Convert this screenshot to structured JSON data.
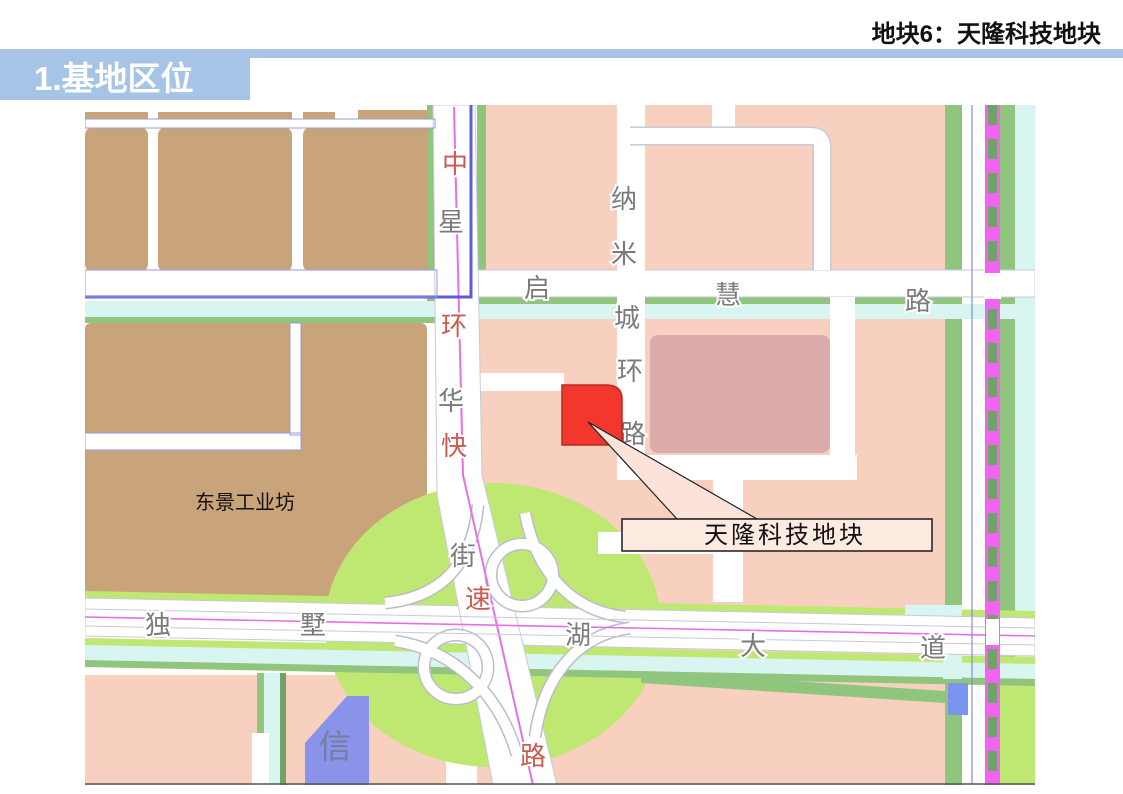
{
  "page": {
    "title_right": "地块6：天隆科技地块",
    "section_banner": "1.基地区位"
  },
  "palette": {
    "header_blue": "#a6c5e6",
    "industrial_tan": "#c9a379",
    "residential_pink": "#f8d0c0",
    "block_mauve": "#dcabab",
    "plot_red": "#f4372d",
    "plot_red_border": "#b62a22",
    "interchange_green": "#bfe873",
    "buffer_green": "#8fc57d",
    "dash_green": "#6fa368",
    "canal_cyan": "#d9f5f2",
    "canal_blue_line": "#5b5be0",
    "parcel_blue": "#8a93ea",
    "transit_magenta": "#f263f2",
    "road_centerline_magenta": "#e76fe7",
    "road_label_gray": "#7b7b7b",
    "road_label_red": "#cd5a52",
    "callout_fill": "#fdeae1"
  },
  "map": {
    "road_names": {
      "expressway": "中环快速路",
      "street": "星华街",
      "ring_road": "纳米城环路",
      "north_road": "启慧路",
      "avenue": "独墅湖大道"
    },
    "road_label_chars": [
      {
        "ch": "中",
        "tone": "red"
      },
      {
        "ch": "星",
        "tone": "gray"
      },
      {
        "ch": "环",
        "tone": "red"
      },
      {
        "ch": "华",
        "tone": "gray"
      },
      {
        "ch": "快",
        "tone": "red"
      },
      {
        "ch": "街",
        "tone": "gray"
      },
      {
        "ch": "速",
        "tone": "red"
      },
      {
        "ch": "路",
        "tone": "red"
      },
      {
        "ch": "纳",
        "tone": "gray"
      },
      {
        "ch": "米",
        "tone": "gray"
      },
      {
        "ch": "城",
        "tone": "gray"
      },
      {
        "ch": "环",
        "tone": "gray"
      },
      {
        "ch": "路",
        "tone": "gray"
      },
      {
        "ch": "启",
        "tone": "gray"
      },
      {
        "ch": "慧",
        "tone": "gray"
      },
      {
        "ch": "路",
        "tone": "gray"
      },
      {
        "ch": "独",
        "tone": "gray"
      },
      {
        "ch": "墅",
        "tone": "gray"
      },
      {
        "ch": "湖",
        "tone": "gray"
      },
      {
        "ch": "大",
        "tone": "gray"
      },
      {
        "ch": "道",
        "tone": "gray"
      }
    ],
    "area_labels": {
      "industrial": "东景工业坊",
      "blue_parcel": "信"
    },
    "callout": {
      "label": "天隆科技地块"
    }
  }
}
